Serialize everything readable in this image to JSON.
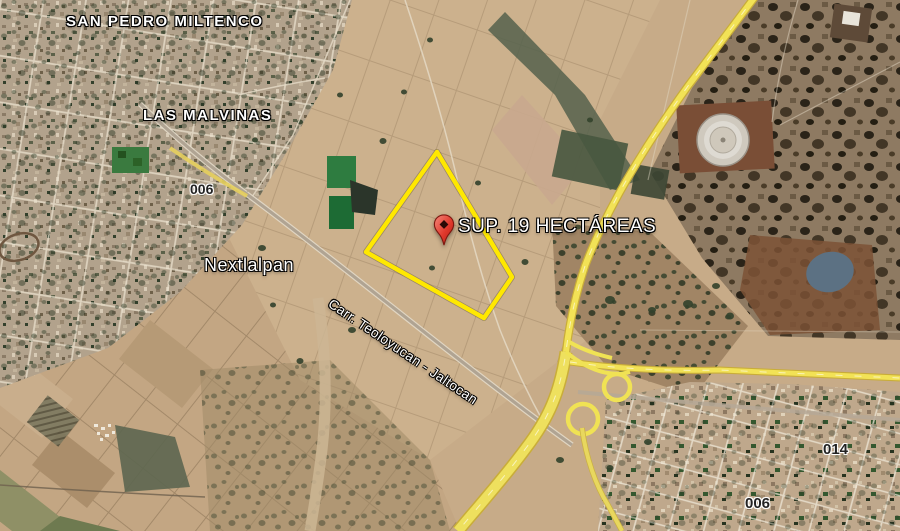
{
  "map_view": {
    "type": "satellite-imagery",
    "place_labels": {
      "san_pedro_miltenco": "SAN PEDRO MILTENCO",
      "las_malvinas": "LAS MALVINAS",
      "nextlalpan": "Nextlalpan"
    },
    "road_labels": {
      "route_006_nw": "006",
      "route_006_se": "006",
      "route_014": "014",
      "carretera": "Carr. Teoloyucan - Jaltocan"
    },
    "property_annotation": {
      "label": "SUP. 19 HECTÁREAS",
      "area_hectares": 19,
      "marker": "red-pin",
      "outline_color": "#ffe800"
    },
    "colors": {
      "highway_yellow": "#f2e256",
      "terrain_tan": "#c7ab88",
      "pin_red": "#d93025"
    }
  }
}
